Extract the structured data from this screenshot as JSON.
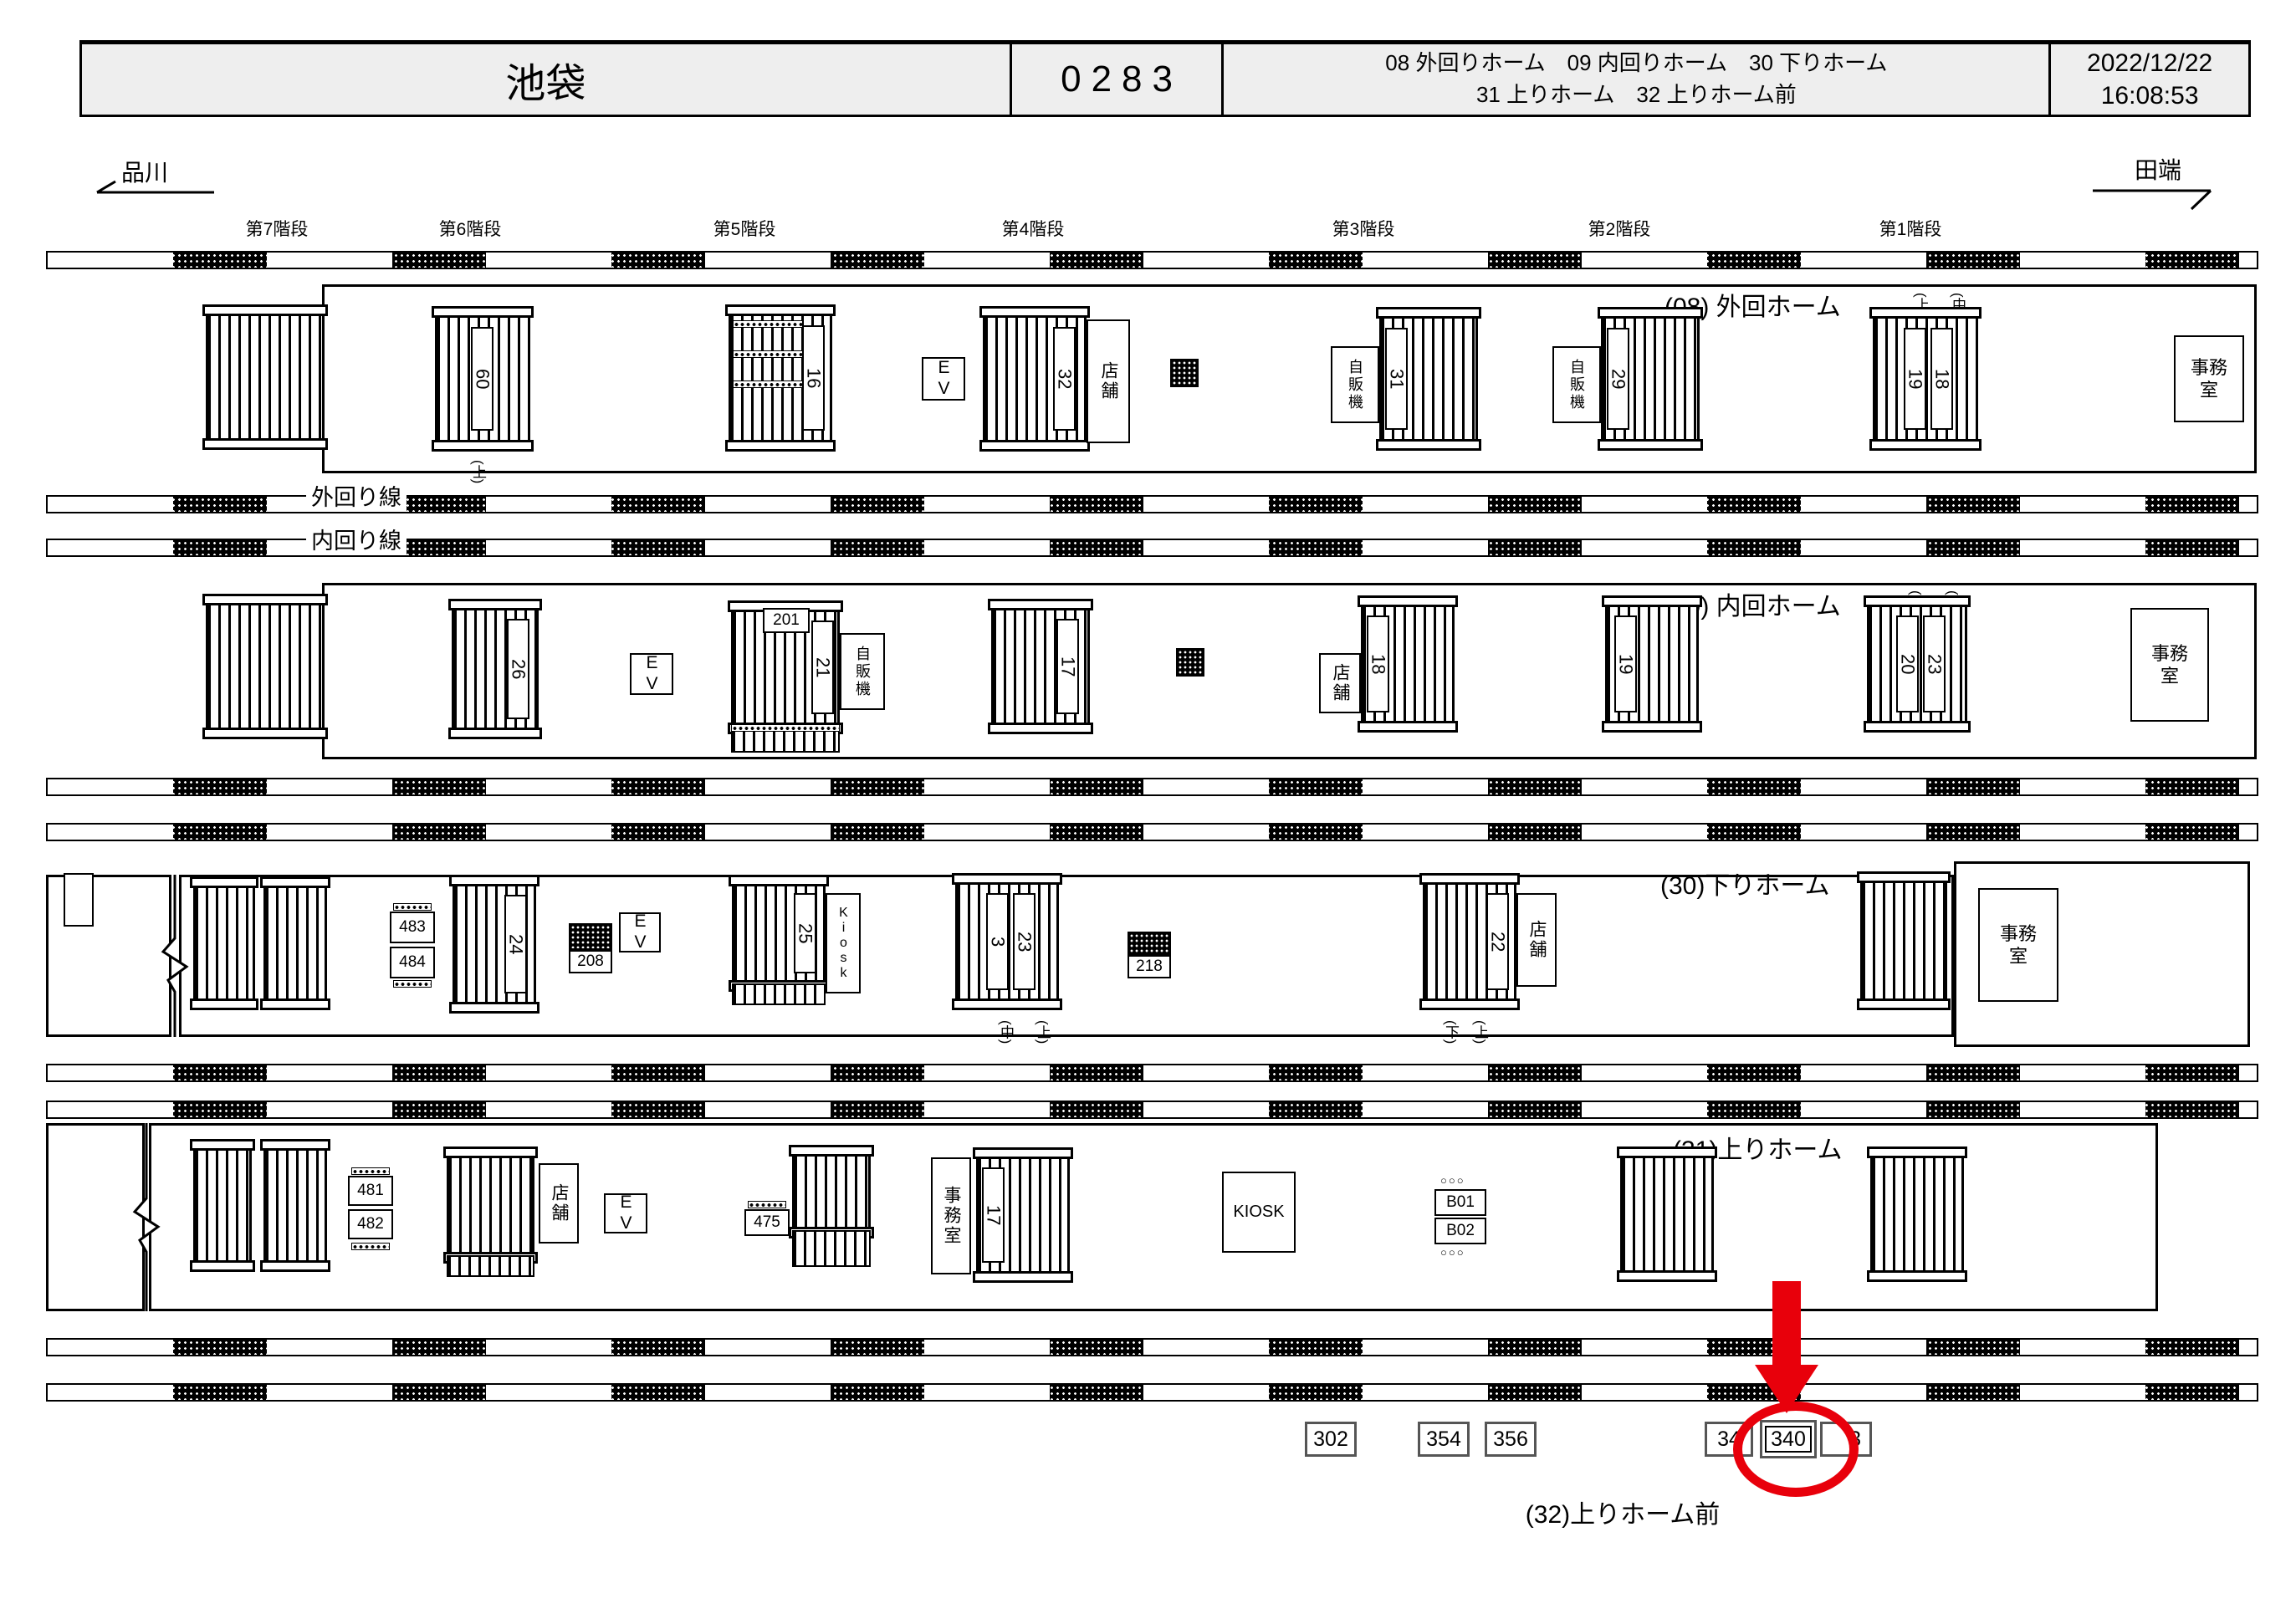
{
  "header": {
    "station": "池袋",
    "code": "0283",
    "platforms_line1": "08 外回りホーム　09 内回りホーム　30 下りホーム",
    "platforms_line2": "31 上りホーム　32 上りホーム前",
    "date": "2022/12/22",
    "time": "16:08:53"
  },
  "directions": {
    "left": "品川",
    "right": "田端"
  },
  "stair_headers": [
    "第7階段",
    "第6階段",
    "第5階段",
    "第4階段",
    "第3階段",
    "第2階段",
    "第1階段"
  ],
  "tracks": {
    "outer_label": "外回り線",
    "inner_label": "内回り線"
  },
  "common": {
    "ev": "EV",
    "shop": "店舗",
    "vending": "自販機",
    "office": "事務室",
    "office_line1": "事務",
    "office_line2": "室",
    "kiosk_v": "Kiosk",
    "kiosk_h": "KIOSK",
    "circles": "○○○"
  },
  "p08": {
    "title": "(08) 外回ホーム",
    "tag_up": "(上)",
    "tag_mid": "(中)",
    "n1": "60",
    "n1_tag": "(上)",
    "n2": "16",
    "n3": "32",
    "n4": "31",
    "n5": "29",
    "n6": "19",
    "n7": "18"
  },
  "p09": {
    "title": "(09) 内回ホーム",
    "tag_up": "(上)",
    "tag_mid": "(中)",
    "n1": "26",
    "n2": "21",
    "n2_box": "201",
    "n3": "17",
    "n4": "18",
    "n5": "19",
    "n6": "20",
    "n7": "23"
  },
  "p30": {
    "title": "(30)下りホーム",
    "e1": "483",
    "e2": "484",
    "n1": "24",
    "h1": "208",
    "n2": "25",
    "n3": "3",
    "n4": "23",
    "n34_tag1": "(中)",
    "n34_tag2": "(上)",
    "h2": "218",
    "n5": "22",
    "n5_tag1": "(下)",
    "n5_tag2": "(上)"
  },
  "p31": {
    "title": "(31)上りホーム",
    "e1": "481",
    "e2": "482",
    "e3": "475",
    "n1": "17",
    "b1": "B01",
    "b2": "B02"
  },
  "bottom": {
    "label": "(32)上りホーム前",
    "b1": "302",
    "b2": "354",
    "b3": "356",
    "b4": "34",
    "b5": "340",
    "b6": "3"
  },
  "colors": {
    "highlight": "#e8000b"
  }
}
